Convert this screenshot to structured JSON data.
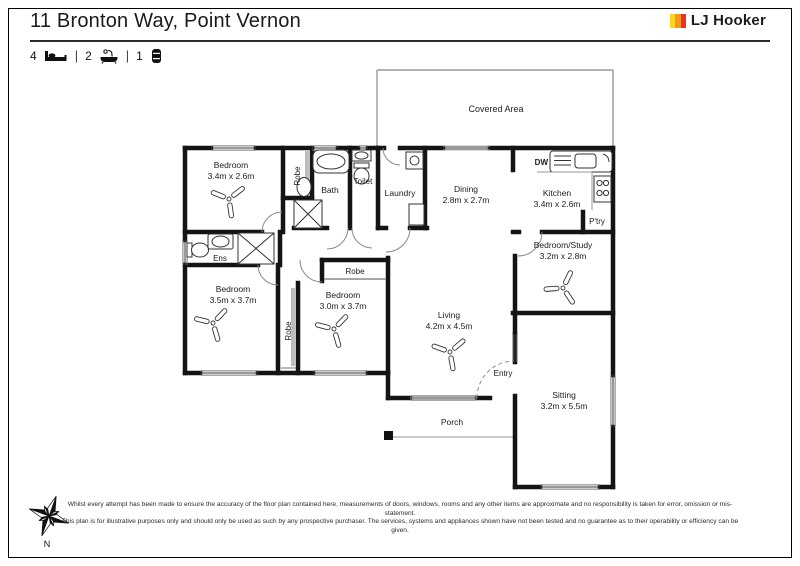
{
  "page": {
    "title": "11 Bronton Way, Point Vernon",
    "logo": {
      "text": "LJ Hooker"
    },
    "summary": {
      "beds": "4",
      "baths": "2",
      "cars": "1"
    },
    "compass": {
      "label": "N"
    },
    "disclaimer": {
      "line1": "Whilst every attempt has been made to ensure the accuracy of the floor plan contained here, measurements of doors, windows, rooms and any other items are approximate and no responsibility is taken for error, omission or mis-statement.",
      "line2": "This plan is for illustrative purposes only and should only be used as such by any prospective purchaser. The services, systems and appliances shown have not been tested and no guarantee as to their operability or efficiency can be given."
    }
  },
  "plan": {
    "rooms": {
      "covered_area": {
        "name": "Covered Area"
      },
      "bedroom1": {
        "name": "Bedroom",
        "dims": "3.4m x 2.6m"
      },
      "robe1": {
        "name": "Robe"
      },
      "bath": {
        "name": "Bath"
      },
      "toilet": {
        "name": "Toilet"
      },
      "laundry": {
        "name": "Laundry"
      },
      "dining": {
        "name": "Dining",
        "dims": "2.8m x 2.7m"
      },
      "kitchen": {
        "name": "Kitchen",
        "dims": "3.4m x 2.6m"
      },
      "dishwasher": {
        "name": "DW"
      },
      "pantry": {
        "name": "P'try"
      },
      "study": {
        "name": "Bedroom/Study",
        "dims": "3.2m x 2.8m"
      },
      "ensuite": {
        "name": "Ens"
      },
      "bedroom2": {
        "name": "Bedroom",
        "dims": "3.5m x 3.7m"
      },
      "robe2": {
        "name": "Robe"
      },
      "bedroom3": {
        "name": "Bedroom",
        "dims": "3.0m x 3.7m"
      },
      "robe3": {
        "name": "Robe"
      },
      "living": {
        "name": "Living",
        "dims": "4.2m x 4.5m"
      },
      "entry": {
        "name": "Entry"
      },
      "sitting": {
        "name": "Sitting",
        "dims": "3.2m x 5.5m"
      },
      "porch": {
        "name": "Porch"
      }
    },
    "colors": {
      "wall": "#141414",
      "logo_yellow": "#FFD520",
      "logo_orange": "#F7941D",
      "logo_red": "#EE3124"
    }
  }
}
